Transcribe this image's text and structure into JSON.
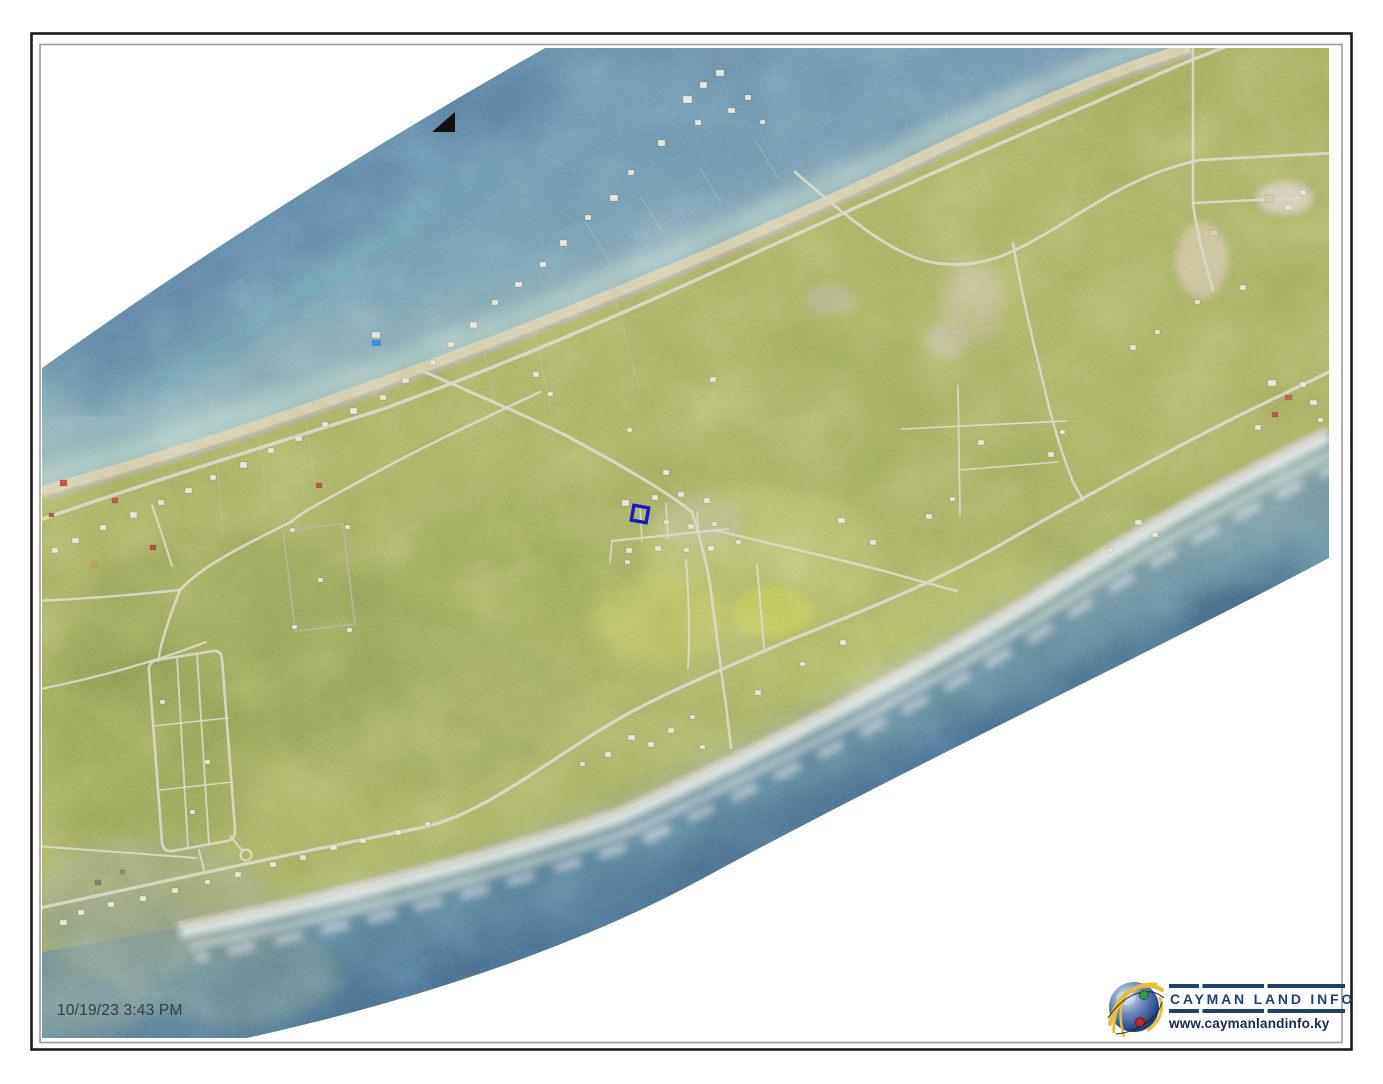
{
  "map": {
    "timestamp": "10/19/23 3:43 PM"
  },
  "branding": {
    "name": "CAYMAN LAND INFO",
    "website": "www.caymanlandinfo.ky"
  },
  "marker": {
    "color": "#1717d6"
  },
  "icons": {
    "north_arrow": "north-arrow",
    "globe_logo": "globe"
  },
  "colors": {
    "frame_outer": "#1c1c1c",
    "frame_inner": "#9b9b9b",
    "land": "#a3ad5e",
    "sea_deep": "#4e7296",
    "sea_shallow": "#9fc0bd",
    "sand": "#d6cdab",
    "road": "#dad8c6",
    "logo_navy": "#20406f"
  }
}
